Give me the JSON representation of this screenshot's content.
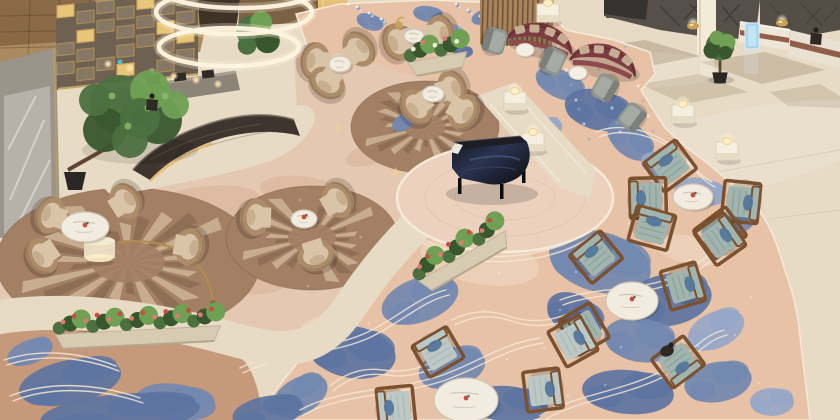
{
  "scene_label": "Overhead view of a hotel lobby lounge with bar, grand piano, seating groups and patterned carpet",
  "colors": {
    "marble": "#e7dbc5",
    "marbleBright": "#f3ead8",
    "marbleShade": "#d6c8b0",
    "inlay": "#bfae96",
    "carpetPink": "#e7c2a6",
    "carpetPale": "#e5c8b1",
    "carpetTan": "#c6997a",
    "blue": "#7388b0",
    "blueDark": "#5d74a1",
    "blueLight": "#97a7c8",
    "contour": "#f3e7d5",
    "rugBase": "#a37f64",
    "rugCream": "#d3bb9e",
    "rugDark": "#7c5d48",
    "tanChair": "#ad8c6a",
    "tanCushion": "#d9c4a8",
    "tanRim": "#8f7154",
    "wood": "#7b512f",
    "teal": "#a2b4ae",
    "tealDark": "#8aa09b",
    "tealPale": "#bcc8c5",
    "pillowBlue": "#54779c",
    "grey": "#8f948e",
    "maroon": "#7d3c41",
    "maroonDark": "#692f35",
    "pillowBeige": "#c4ad92",
    "gold": "#c9a254",
    "goldBright": "#f1d287",
    "counter": "#3d352e",
    "counterVein": "#6e6052",
    "wallTile": "#aa8b60",
    "wallTileDark": "#8a6a46",
    "wallGrey": "#9a948a",
    "glass": "#b8b3ab",
    "wallDark": "#57504a",
    "charcoal": "#3b3a38",
    "slatWood": "#a8845c",
    "slatLine": "#6e5138",
    "green": "#4c7040",
    "greenDark": "#39572f",
    "greenLight": "#6fa054",
    "trunk": "#5d4532",
    "pot": "#2b2724",
    "flowerPink": "#e07a70",
    "flowerRed": "#c94b44",
    "flowerWhite": "#f2ead8",
    "piano": "#16161b",
    "keys": "#eae7de",
    "glow": "#ffeec2",
    "lampGold": "#b08d4f",
    "white": "#f6f0e3",
    "signBlue": "#a9d6ec",
    "figure": "#2e2925"
  },
  "scene": {
    "chandelier_rings": [
      [
        240,
        -14,
        84,
        22
      ],
      [
        234,
        12,
        78,
        22
      ],
      [
        229,
        47,
        70,
        19
      ]
    ],
    "rugs": [
      [
        128,
        262,
        132,
        74
      ],
      [
        312,
        238,
        86,
        52
      ],
      [
        425,
        127,
        74,
        46
      ]
    ],
    "carpet_blobs": [
      [
        370,
        22,
        14,
        8,
        20,
        "blue"
      ],
      [
        398,
        34,
        12,
        7,
        -15,
        "blueDark"
      ],
      [
        428,
        14,
        15,
        8,
        10,
        "blue"
      ],
      [
        455,
        32,
        13,
        7,
        30,
        "blueLight"
      ],
      [
        483,
        17,
        12,
        7,
        -20,
        "blue"
      ],
      [
        510,
        36,
        14,
        8,
        15,
        "blueDark"
      ],
      [
        537,
        22,
        12,
        6,
        0,
        "blue"
      ],
      [
        463,
        52,
        10,
        6,
        0,
        "blueDark"
      ],
      [
        352,
        42,
        9,
        6,
        0,
        "blueLight"
      ],
      [
        560,
        84,
        26,
        14,
        25,
        "blue"
      ],
      [
        598,
        110,
        34,
        20,
        15,
        "blueDark"
      ],
      [
        630,
        140,
        26,
        16,
        40,
        "blue"
      ],
      [
        545,
        130,
        18,
        11,
        -20,
        "blueLight"
      ],
      [
        660,
        165,
        20,
        12,
        20,
        "blueLight"
      ],
      [
        700,
        192,
        26,
        14,
        10,
        "blueLight"
      ],
      [
        736,
        222,
        20,
        12,
        -15,
        "blue"
      ],
      [
        404,
        122,
        13,
        8,
        -30,
        "blue"
      ],
      [
        600,
        262,
        52,
        30,
        15,
        "blue"
      ],
      [
        668,
        300,
        44,
        26,
        -10,
        "blueDark"
      ],
      [
        575,
        315,
        30,
        20,
        30,
        "blueDark"
      ],
      [
        640,
        340,
        36,
        22,
        10,
        "blue"
      ],
      [
        716,
        330,
        30,
        18,
        -25,
        "blueLight"
      ],
      [
        628,
        392,
        46,
        22,
        5,
        "blueDark"
      ],
      [
        718,
        382,
        34,
        20,
        -10,
        "blue"
      ],
      [
        772,
        402,
        22,
        14,
        0,
        "blueLight"
      ],
      [
        420,
        300,
        40,
        22,
        -20,
        "blue"
      ],
      [
        352,
        352,
        44,
        26,
        10,
        "blueDark"
      ],
      [
        452,
        368,
        34,
        20,
        -15,
        "blue"
      ],
      [
        508,
        404,
        40,
        18,
        5,
        "blueDark"
      ],
      [
        300,
        396,
        30,
        18,
        -30,
        "blue"
      ],
      [
        268,
        412,
        36,
        16,
        -10,
        "blueDark"
      ],
      [
        70,
        382,
        52,
        22,
        -12,
        "blueDark"
      ],
      [
        176,
        402,
        40,
        18,
        8,
        "blue"
      ],
      [
        30,
        352,
        24,
        12,
        -20,
        "blue"
      ],
      [
        120,
        414,
        80,
        20,
        -5,
        "blueDark"
      ]
    ],
    "contours": [
      "M240,368 C280,348 330,350 368,332 C400,316 420,296 446,290",
      "M300,410 C340,388 390,392 440,376 C480,362 500,344 540,338",
      "M540,416 C570,396 620,392 660,372 C690,356 700,336 724,330",
      "M560,300 C596,286 640,292 676,276 C704,264 712,246 736,242",
      "M596,132 C620,122 650,130 672,146 C688,158 696,174 712,182",
      "M10,396 C50,380 100,384 140,398",
      "M4,360 C40,348 80,352 116,366",
      "M452,320 q28,-14 56,-4 q30,10 60,-2",
      "M420,238 q40,22 90,18 q50,-4 80,-26",
      "M330,386 q24,-20 52,-16 q30,4 54,-10"
    ],
    "mottles_b": [
      [
        200,
        205,
        60,
        18,
        -8
      ],
      [
        300,
        190,
        40,
        14,
        5
      ],
      [
        150,
        300,
        50,
        16,
        -15
      ],
      [
        380,
        150,
        36,
        12,
        -20
      ],
      [
        240,
        280,
        44,
        14,
        6
      ]
    ],
    "mottles_c": [
      [
        480,
        260,
        60,
        24,
        10
      ],
      [
        560,
        220,
        40,
        16,
        -15
      ],
      [
        330,
        330,
        30,
        14,
        0
      ],
      [
        690,
        250,
        36,
        14,
        12
      ]
    ],
    "tan_chairs": [
      [
        50,
        215,
        85,
        227
      ],
      [
        126,
        201,
        85,
        227
      ],
      [
        190,
        247,
        85,
        227
      ],
      [
        42,
        256,
        85,
        227
      ],
      [
        255,
        217,
        304,
        219
      ],
      [
        338,
        200,
        304,
        219
      ],
      [
        316,
        256,
        304,
        219
      ],
      [
        315,
        61,
        340,
        64
      ],
      [
        327,
        83,
        340,
        64
      ],
      [
        359,
        49,
        340,
        64
      ],
      [
        397,
        42,
        414,
        36
      ],
      [
        440,
        34,
        414,
        36
      ],
      [
        452,
        89,
        433,
        94
      ],
      [
        416,
        107,
        433,
        94
      ],
      [
        464,
        112,
        433,
        94
      ]
    ],
    "teal_chairs": [
      [
        670,
        166,
        693,
        197
      ],
      [
        648,
        198,
        693,
        197
      ],
      [
        741,
        202,
        693,
        197
      ],
      [
        720,
        233,
        693,
        197
      ],
      [
        596,
        257,
        632,
        301
      ],
      [
        652,
        228,
        632,
        301
      ],
      [
        720,
        239,
        632,
        301
      ],
      [
        683,
        286,
        632,
        301
      ],
      [
        678,
        362,
        632,
        301
      ],
      [
        584,
        329,
        632,
        301
      ],
      [
        438,
        352,
        466,
        400
      ],
      [
        543,
        390,
        466,
        400
      ],
      [
        573,
        341,
        466,
        400
      ],
      [
        396,
        407,
        466,
        400
      ]
    ],
    "grey_chairs": [
      [
        495,
        41,
        525,
        50
      ],
      [
        553,
        61,
        578,
        73
      ],
      [
        605,
        88,
        578,
        73
      ],
      [
        632,
        117,
        610,
        100
      ]
    ],
    "sofas": [
      [
        540,
        41,
        12
      ],
      [
        604,
        62,
        14
      ]
    ],
    "marble_tables": [
      [
        85,
        227,
        24,
        15,
        1
      ],
      [
        304,
        219,
        13,
        9,
        1
      ],
      [
        340,
        64,
        11,
        8,
        0
      ],
      [
        414,
        36,
        10,
        7,
        0
      ],
      [
        433,
        94,
        11,
        8,
        0
      ],
      [
        693,
        197,
        20,
        13,
        1
      ],
      [
        632,
        301,
        26,
        19,
        1
      ],
      [
        466,
        400,
        32,
        22,
        1
      ]
    ],
    "small_tables": [
      [
        525,
        50
      ],
      [
        578,
        73
      ]
    ],
    "pedestals": [
      [
        515,
        100
      ],
      [
        533,
        141
      ],
      [
        683,
        113
      ],
      [
        727,
        150
      ],
      [
        548,
        12
      ]
    ],
    "bowl_lamps": [
      [
        693,
        26
      ],
      [
        782,
        23
      ]
    ],
    "planters": [
      {
        "x": 138,
        "y": 330,
        "len": 165,
        "rot": -3,
        "type": "pink"
      },
      {
        "x": 462,
        "y": 256,
        "len": 100,
        "rot": -30,
        "type": "pink"
      },
      {
        "x": 437,
        "y": 57,
        "len": 60,
        "rot": -10,
        "type": "white"
      }
    ],
    "trees_sym": [
      [
        720,
        46,
        0.55
      ]
    ],
    "gold_stars": [
      [
        396,
        172
      ],
      [
        338,
        128
      ]
    ],
    "persons": [
      [
        816,
        34
      ],
      [
        152,
        100
      ]
    ],
    "seated_person": [
      667,
      351
    ]
  }
}
